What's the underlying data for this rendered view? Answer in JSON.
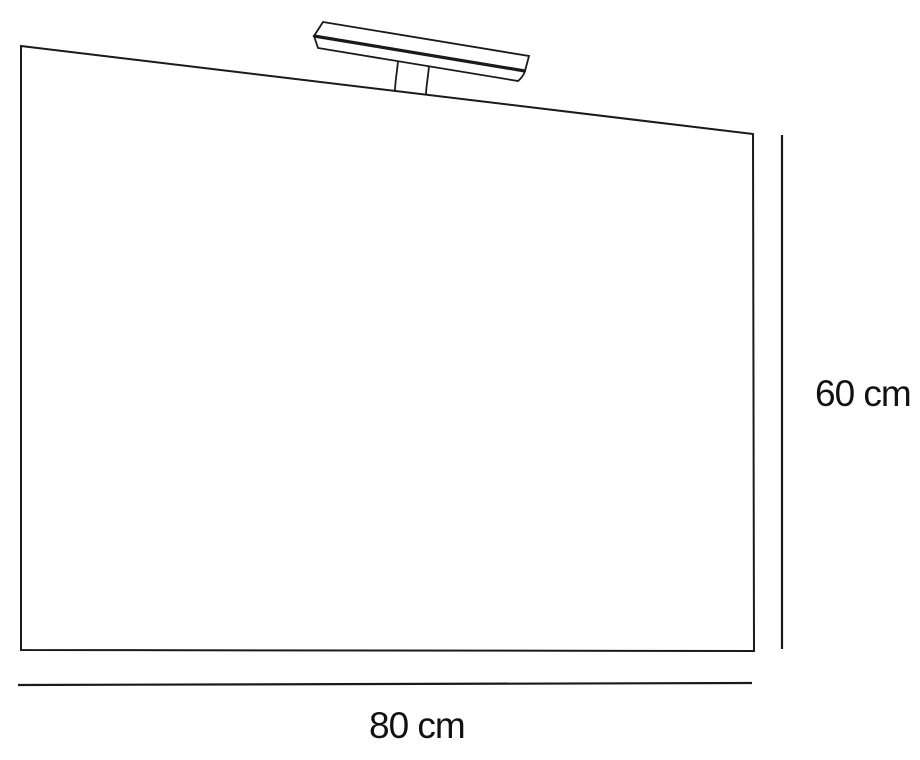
{
  "diagram": {
    "labels": {
      "height": "60 cm",
      "width": "80 cm"
    },
    "colors": {
      "line": "#1a1a1a",
      "text": "#111111",
      "background": "#ffffff"
    }
  }
}
